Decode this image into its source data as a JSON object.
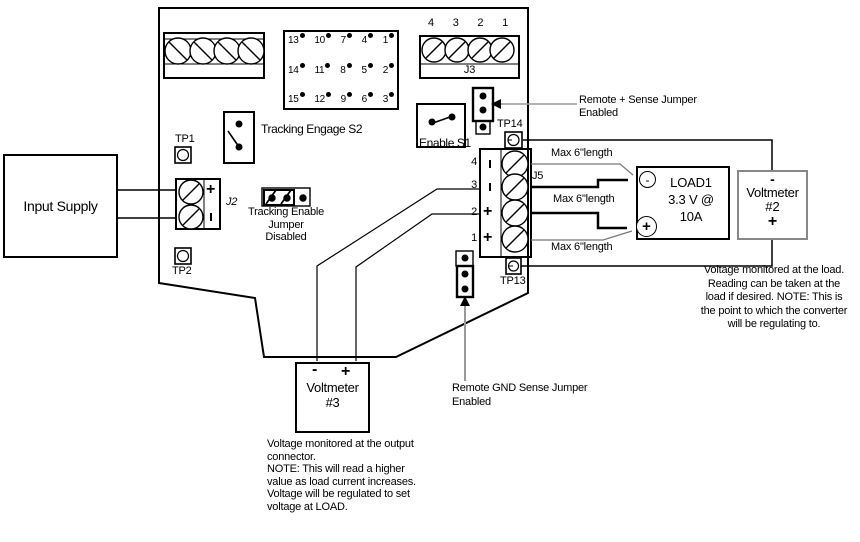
{
  "diagram": {
    "input_supply": {
      "label": "Input Supply"
    },
    "board": {
      "test_points": {
        "tp1": "TP1",
        "tp2": "TP2",
        "tp13": "TP13",
        "tp14": "TP14"
      },
      "terminal_block_j3": {
        "label": "J3",
        "pins": [
          "4",
          "3",
          "2",
          "1"
        ]
      },
      "header15": {
        "rows": [
          [
            "13",
            "10",
            "7",
            "4",
            "1"
          ],
          [
            "14",
            "11",
            "8",
            "5",
            "2"
          ],
          [
            "15",
            "12",
            "9",
            "6",
            "3"
          ]
        ]
      },
      "terminal_block_j2": {
        "label": "J2",
        "plus": "+",
        "minus": "-"
      },
      "terminal_block_j5": {
        "label": "J5",
        "pins": [
          "4",
          "3",
          "2",
          "1"
        ],
        "polarity": [
          "-",
          "-",
          "+",
          "+"
        ],
        "plus": "+"
      },
      "switch_s2": {
        "label": "Tracking Engage S2"
      },
      "switch_s1": {
        "label": "Enable S1"
      },
      "jumper_tracking_enable": {
        "lines": [
          "Tracking Enable",
          "Jumper",
          "Disabled"
        ]
      },
      "jumper_remote_plus": {
        "lines": [
          "Remote + Sense Jumper",
          "Enabled"
        ]
      },
      "jumper_remote_gnd": {
        "lines": [
          "Remote GND Sense Jumper",
          "Enabled"
        ]
      }
    },
    "load": {
      "name": "LOAD1",
      "spec_line1": "3.3 V @",
      "spec_line2": "10A",
      "minus": "-",
      "plus": "+"
    },
    "voltmeter2": {
      "title": "Voltmeter",
      "number": "#2",
      "minus": "-",
      "plus": "+",
      "note_lines": [
        "Voltage monitored at the load.",
        "Reading can be taken at the",
        "load if desired. NOTE: This is",
        "the point to which the converter",
        "will be regulating to."
      ]
    },
    "voltmeter3": {
      "title": "Voltmeter",
      "number": "#3",
      "minus": "-",
      "plus": "+",
      "note_lines": [
        "Voltage monitored at the output",
        "connector.",
        "NOTE: This will read a higher",
        "value as load current increases.",
        "Voltage will be regulated to set",
        "voltage at LOAD."
      ]
    },
    "wire_label_max_length": "Max 6\"length",
    "colors": {
      "line": "#000000",
      "leader": "#999999",
      "voltmeter2_border": "#888888"
    }
  }
}
